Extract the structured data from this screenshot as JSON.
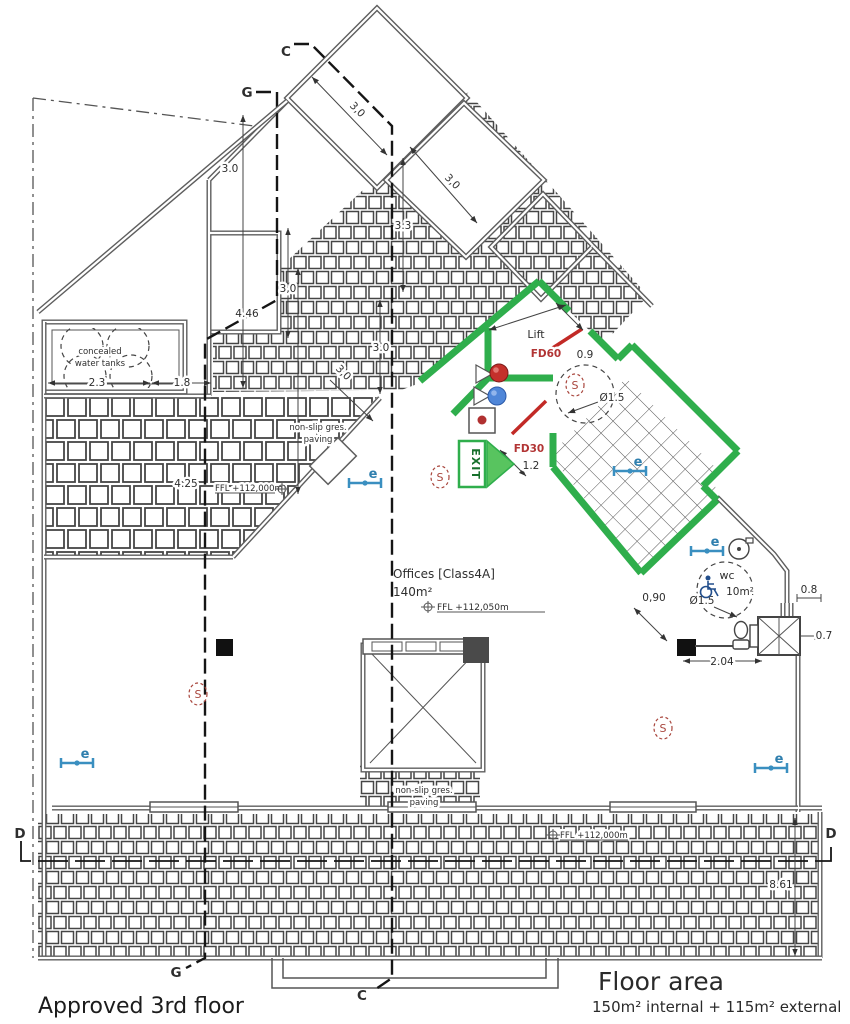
{
  "plan": {
    "title": "Approved 3rd floor",
    "area": {
      "title": "Floor area",
      "detail": "150m² internal + 115m² external"
    },
    "rooms": {
      "offices": "Offices [Class4A]",
      "offices_area": "140m²",
      "lift": "Lift",
      "wc": "wc",
      "wc_area": "10m²",
      "tanks1": "concealed",
      "tanks2": "water tanks",
      "paving1": "non-slip gres.",
      "paving2": "paving"
    },
    "safety": {
      "fd60": "FD60",
      "fd30": "FD30",
      "exit": "EXIT",
      "smoke": "S",
      "emergency": "e"
    },
    "levels": {
      "terrace_left": "FFL +112,000m",
      "office": "FFL +112,050m",
      "terrace_bottom": "FFL +112,000m"
    },
    "sections": {
      "c": "C",
      "g": "G",
      "d": "D"
    },
    "dims": {
      "top_offset": "3.0",
      "wing_width_a": "3,0",
      "wing_width_b": "3,0",
      "wing_height": "3.3",
      "room_g": "3,0",
      "g_height": "4.46",
      "strip_a": "3.0",
      "strip_b": "3,0",
      "tanks": "2.3",
      "tanks_gap": "1.8",
      "terrace": "4.25",
      "lift_door": "0.9",
      "lobby_door": "1.2",
      "circle_a": "Ø1.5",
      "circle_b": "Ø1.5",
      "wc_door": "0,90",
      "wc_width": "2.04",
      "duct_a": "0.8",
      "duct_b": "0.7",
      "terrace_depth": "8.61"
    },
    "colors": {
      "wall_green": "#2fae4c",
      "door_red": "#c22a26",
      "symbol_blue": "#3a8fc0",
      "detector_red": "#a8453c",
      "exit_green": "#58c45f"
    }
  }
}
